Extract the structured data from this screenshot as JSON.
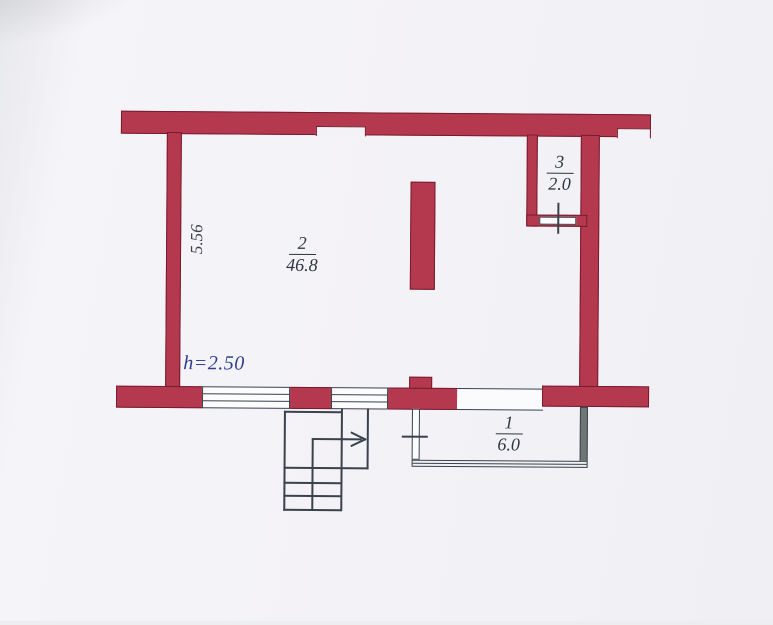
{
  "plan": {
    "rooms": [
      {
        "number": "1",
        "area": "6.0"
      },
      {
        "number": "2",
        "area": "46.8"
      },
      {
        "number": "3",
        "area": "2.0"
      }
    ],
    "wall_dimension": "5.56",
    "ceiling_height": "h=2.50",
    "colors": {
      "wall_fill": "#b4394f",
      "wall_outline": "#771b2e",
      "line": "#3a424c",
      "label_text": "#2e3640",
      "height_text": "#2e3e8c",
      "paper": "#f3f2f6"
    }
  }
}
